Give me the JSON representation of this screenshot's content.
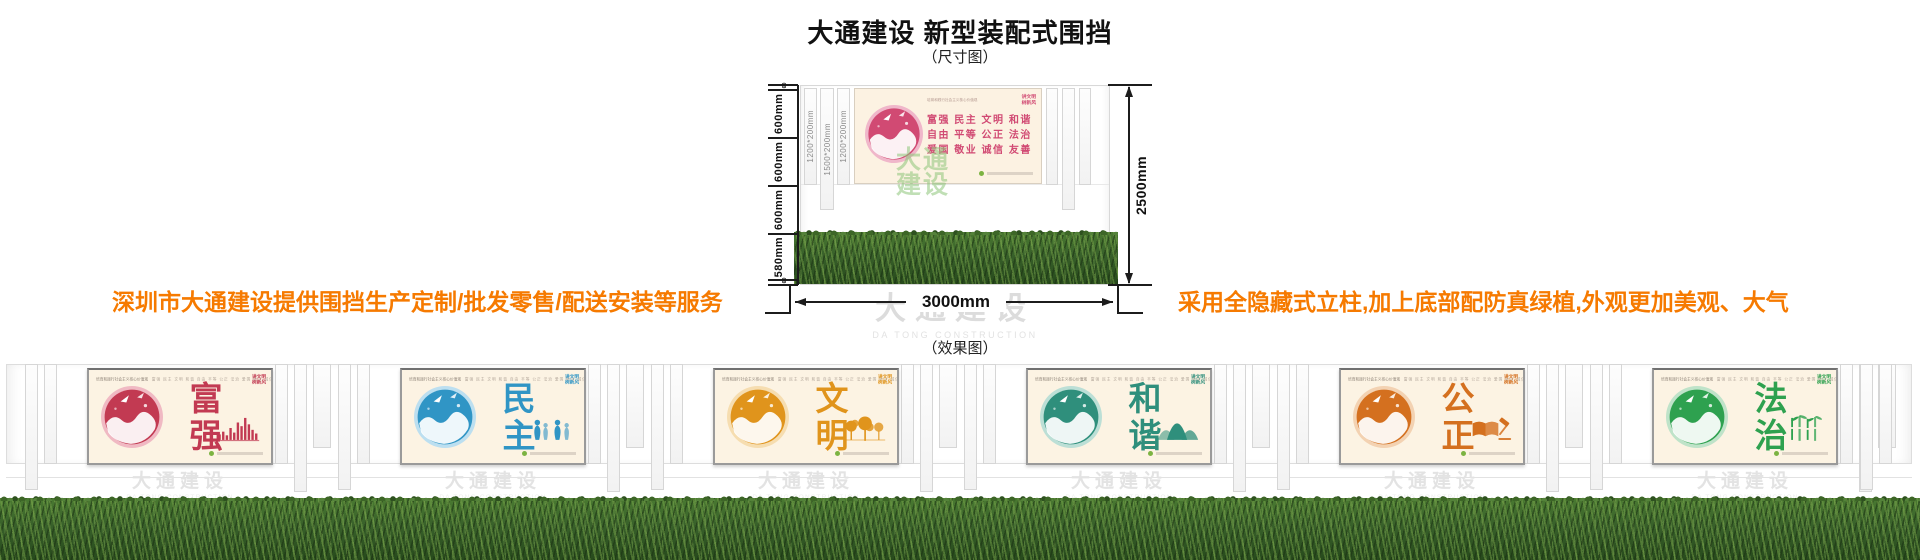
{
  "header": {
    "title": "大通建设 新型装配式围挡",
    "dim_caption": "（尺寸图）",
    "effect_caption": "（效果图）"
  },
  "annotations": {
    "left": "深圳市大通建设提供围挡生产定制/批发零售/配送安装等服务",
    "right": "采用全隐藏式立柱,加上底部配防真绿植,外观更加美观、大气",
    "color": "#f67a00"
  },
  "dimensions": {
    "left_segments": [
      {
        "label": "60",
        "mm": 60
      },
      {
        "label": "600mm",
        "mm": 600
      },
      {
        "label": "600mm",
        "mm": 600
      },
      {
        "label": "600mm",
        "mm": 600
      },
      {
        "label": "580mm",
        "mm": 580
      },
      {
        "label": "60",
        "mm": 60
      }
    ],
    "height_total": "2500mm",
    "width_total": "3000mm",
    "post_labels": [
      "1200*200mm",
      "1500*200mm",
      "1200*200mm"
    ]
  },
  "core_values_panel": {
    "rows": [
      "富强 民主 文明 和谐",
      "自由 平等 公正 法治",
      "爱国 敬业 诚信 友善"
    ],
    "accent": "#d14a73",
    "accent_light": "#f0b7ca"
  },
  "poster_common": {
    "header_phrase": "培育和践行社会主义核心价值观",
    "header_values": "富强 民主 文明 和谐 自由 平等 公正 法治 爱国 敬业 诚信 友善",
    "badge": [
      "讲文明",
      "树新风"
    ]
  },
  "watermark": {
    "zh": "大通建设",
    "en": "DA TONG CONSTRUCTION"
  },
  "effect_panels": [
    {
      "word": "富强",
      "color": "#c23a52",
      "light": "#f0b9c3",
      "motif": "skyline-bars",
      "circle_motif": "papercut-city"
    },
    {
      "word": "民主",
      "color": "#3095c5",
      "light": "#bcdff0",
      "motif": "people",
      "circle_motif": "people-doves"
    },
    {
      "word": "文明",
      "color": "#e0941c",
      "light": "#f6ddb0",
      "motif": "trees",
      "circle_motif": "dove-globe"
    },
    {
      "word": "和谐",
      "color": "#2f8f7c",
      "light": "#bcdfd6",
      "motif": "mountains",
      "circle_motif": "bird-branch"
    },
    {
      "word": "公正",
      "color": "#d4701f",
      "light": "#f3d2b2",
      "motif": "book-gavel",
      "circle_motif": "gavel-book"
    },
    {
      "word": "法治",
      "color": "#2ea14f",
      "light": "#bfe3c9",
      "motif": "bamboo",
      "circle_motif": "figure-bamboo"
    }
  ],
  "hedge": {
    "color_dark": "#274a1c",
    "color_mid": "#38602a",
    "color_light": "#6f9c3f"
  }
}
